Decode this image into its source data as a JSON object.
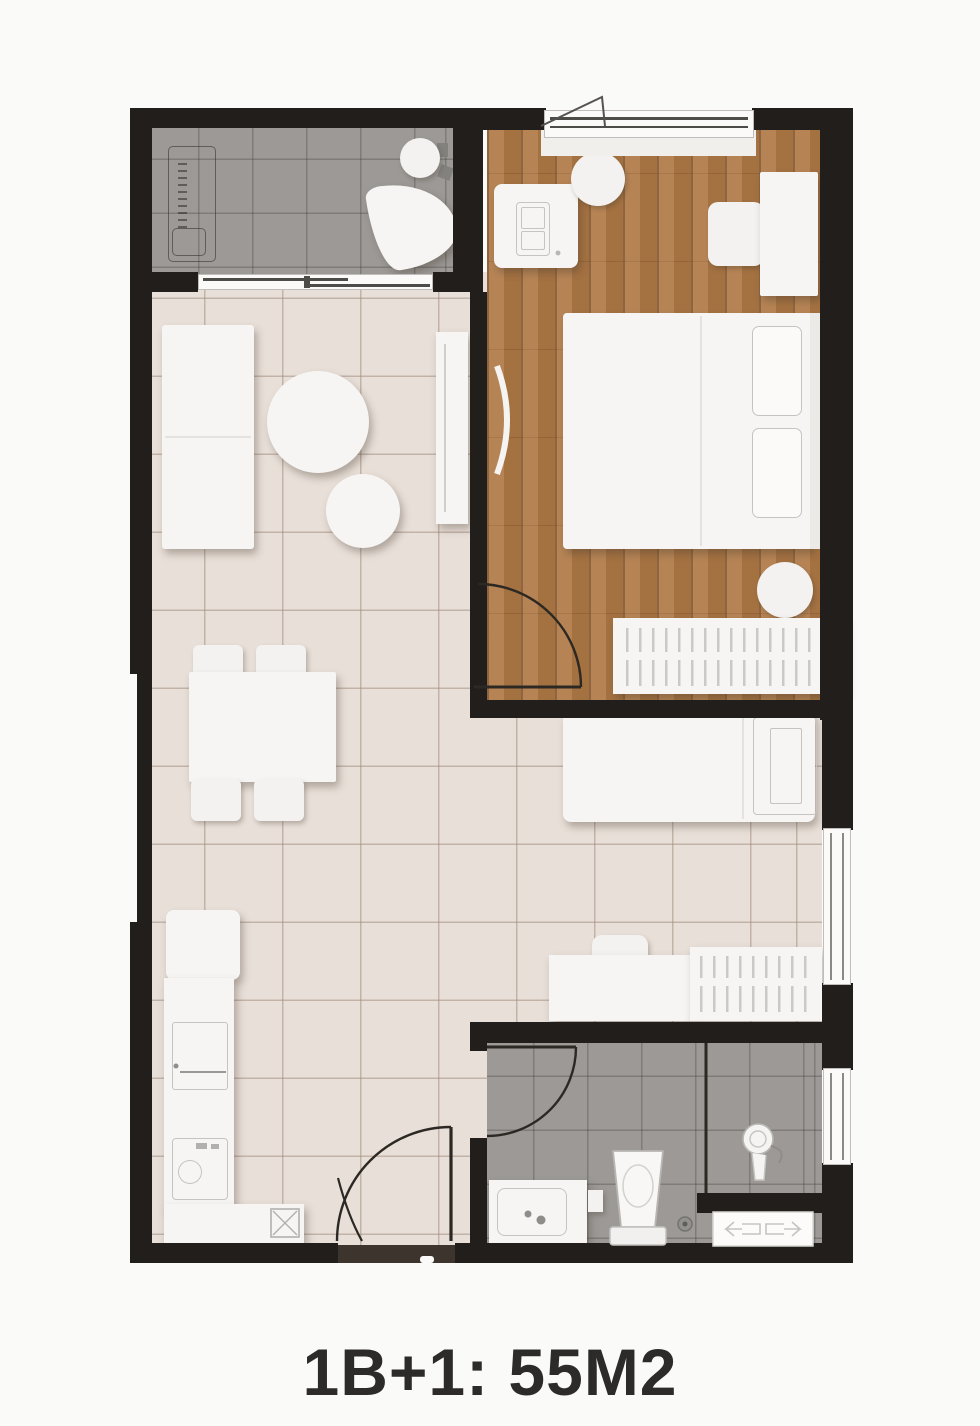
{
  "title": {
    "label": "1B+1: 55M2"
  },
  "palette": {
    "background": "#fafaf9",
    "wall": "#211e1c",
    "wood_floor": "#b07a46",
    "tile_beige": "#e8dfd8",
    "tile_gray": "#9c9996",
    "furniture_white": "#f6f5f3",
    "title_color": "#2c2b2a",
    "door_line": "#2c2823"
  },
  "plan": {
    "type": "apartment-floor-plan",
    "unit_label": "1B+1: 55M2",
    "rooms": [
      "utility-laundry-room",
      "bedroom",
      "living-room",
      "dining-area",
      "kitchen",
      "multipurpose-room",
      "bathroom"
    ],
    "fixtures": [
      "washing-machine-outline",
      "laundry-basin",
      "round-basin",
      "window-sliding-door",
      "open-casement-window",
      "desk",
      "laptop",
      "stool",
      "nightstand",
      "dresser",
      "double-bed",
      "pillows",
      "round-rug",
      "wardrobe-hanging-clothes",
      "sofa",
      "coffee-table-large",
      "coffee-table-small",
      "tv-console",
      "wall-tv",
      "dining-table",
      "dining-chairs",
      "fridge",
      "kitchen-counter",
      "cabinet",
      "kitchen-sink",
      "stove",
      "single-bed",
      "desk-chair",
      "small-wardrobe",
      "vanity-sink",
      "toilet",
      "shower-head",
      "floor-drain",
      "louver-panel",
      "entry-door",
      "bathroom-door",
      "bedroom-door"
    ]
  }
}
